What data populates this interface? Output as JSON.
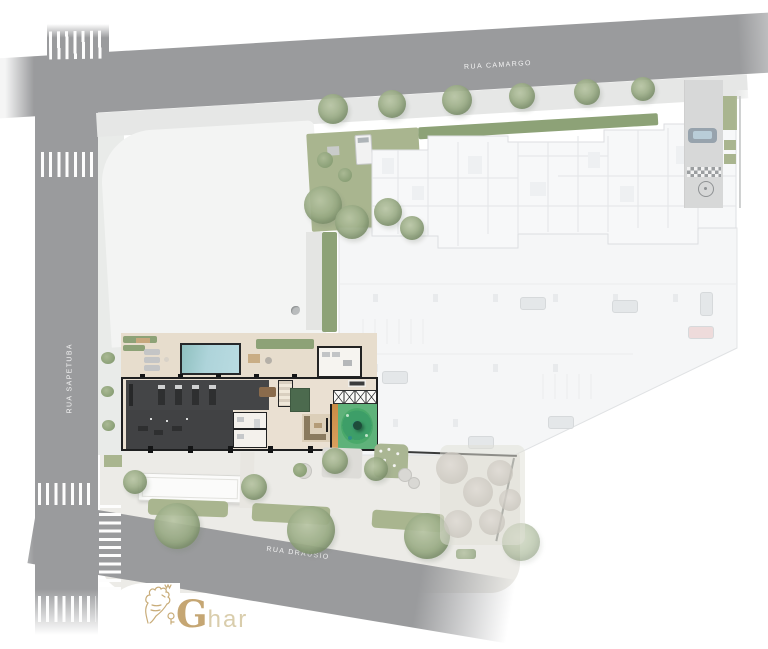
{
  "site_plan": {
    "streets": {
      "top": {
        "label": "RUA CAMARGO"
      },
      "left": {
        "label": "RUA SAPETUBA"
      },
      "bottom": {
        "label": "RUA DRAÚSIO"
      }
    },
    "watermark": {
      "initial": "G",
      "rest": "har"
    },
    "colors": {
      "road": "#9a9b9d",
      "sidewalk": "#e7e8e6",
      "pavement": "#ecebe7",
      "lawn": "#a9b58f",
      "hedge": "#8da277",
      "tree": "#94a77f",
      "deck": "#e7ddcd",
      "wall": "#1e1f20",
      "gym": "#444547",
      "pool": "#aed4da",
      "rug": "#4c6a4e",
      "wood": "#8a6b4c",
      "sand": "#c98b45",
      "playground_green": "#4aa96a",
      "playground_teal": "#2f8e86",
      "ghost_fill": "#f6f7f8",
      "ghost_line": "#dcdee1",
      "gold": "#c6a872",
      "gold_light": "#d8cba8",
      "crosswalk": "#fdfdfd"
    },
    "icons": {
      "tree": "textured circle",
      "bush": "small circle",
      "car": "rounded rect",
      "van": "white rect with windshield",
      "pool": "blue rect",
      "crosswalk": "white stripe band",
      "checker-strip": "checkerboard band",
      "turnaround": "circle with dot",
      "lion-key-logo": "gold line flourish",
      "storage-x": "cells with diagonals"
    }
  }
}
